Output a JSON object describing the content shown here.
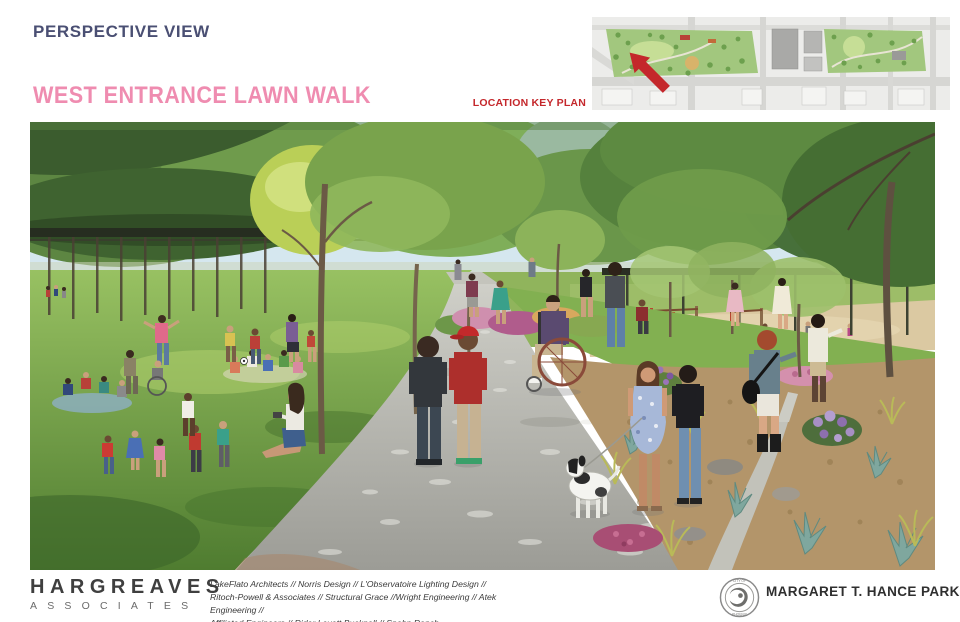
{
  "page": {
    "title": "PERSPECTIVE VIEW",
    "subtitle": "WEST ENTRANCE LAWN WALK"
  },
  "key_plan": {
    "label": "LOCATION KEY PLAN",
    "arrow_icon": "red-location-arrow",
    "arrow_color": "#c4272b"
  },
  "footer": {
    "firm": {
      "name": "HARGREAVES",
      "subtitle": "ASSOCIATES"
    },
    "credits": [
      "LakeFlato Architects // Norris Design // L'Observatoire Lighting Design //",
      "Ritoch-Powell & Associates // Structural Grace //Wright Engineering // Atek Engineering //",
      "Affiliated Engineers // Rider Levett Bucknall // Spohn Ranch"
    ],
    "client_logo": {
      "icon": "city-of-phoenix-seal",
      "text_top": "CITY OF",
      "text_bottom": "PHOENIX"
    },
    "park_name": "MARGARET T. HANCE PARK"
  },
  "colors": {
    "title_navy": "#4a4f73",
    "subtitle_pink": "#ef8cb0",
    "key_label_red": "#c4272b",
    "footer_dark": "#3f3f3f"
  }
}
